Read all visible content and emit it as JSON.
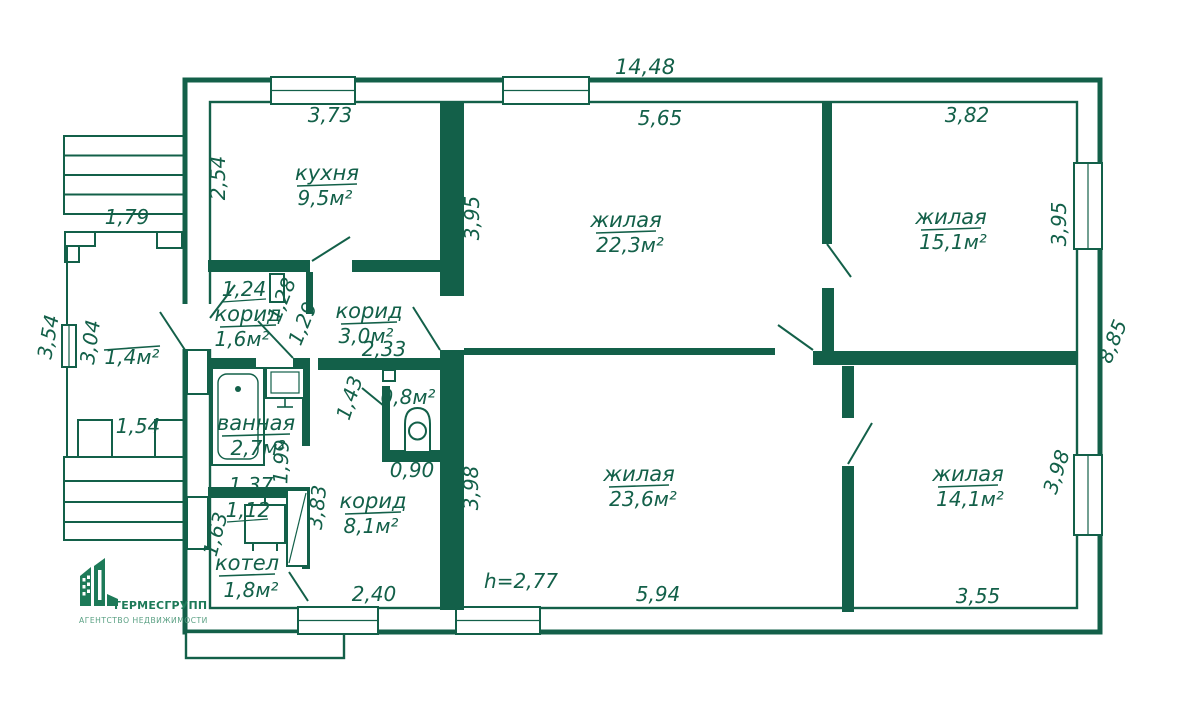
{
  "colors": {
    "ink": "#136049",
    "logo": "#1d7a58",
    "tagline": "#5aa083",
    "bg": "#ffffff"
  },
  "branding": {
    "company": "ГЕРМЕСГРУПП",
    "tagline": "АГЕНТСТВО НЕДВИЖИМОСТИ"
  },
  "rooms": {
    "kitchen": {
      "name": "кухня",
      "area": "9,5м²"
    },
    "living1": {
      "name": "жилая",
      "area": "22,3м²"
    },
    "living2": {
      "name": "жилая",
      "area": "15,1м²"
    },
    "living3": {
      "name": "жилая",
      "area": "23,6м²"
    },
    "living4": {
      "name": "жилая",
      "area": "14,1м²"
    },
    "hall_small": {
      "name": "корид",
      "area": "1,6м²"
    },
    "hall_mid": {
      "name": "корид",
      "area": "3,0м²"
    },
    "hall_big": {
      "name": "корид",
      "area": "8,1м²"
    },
    "bathroom": {
      "name": "ванная",
      "area": "2,7м²"
    },
    "boiler": {
      "name": "котел",
      "area": "1,8м²"
    },
    "wc": {
      "area": "0,8м²"
    },
    "porch": {
      "area": "1,4м²"
    }
  },
  "dimensions": {
    "overall_top": "14,48",
    "kitchen_top": "3,73",
    "living1_top": "5,65",
    "living2_top": "3,82",
    "kitchen_left": "2,54",
    "living1_left": "3,95",
    "living2_right": "3,95",
    "right_overall": "8,85",
    "stairs_top": "1,79",
    "porch_left": "3,54",
    "porch_room_left": "3,04",
    "porch_bottom": "1,54",
    "hall1_top": "1,24",
    "hall1_a": "1,28",
    "hall1_b": "1,29",
    "hall2_width": "2,33",
    "wc_left": "1,43",
    "wc_bottom": "0,90",
    "bath_bottom": "1,37",
    "bath_right": "1,99",
    "boiler_top": "1,12",
    "boiler_left": "1,63",
    "hall3_left": "3,83",
    "hall3_bottom": "2,40",
    "living3_left": "3,98",
    "living3_bottom": "5,94",
    "living4_right": "3,98",
    "living4_bottom": "3,55",
    "ceiling_height": "h=2,77"
  }
}
